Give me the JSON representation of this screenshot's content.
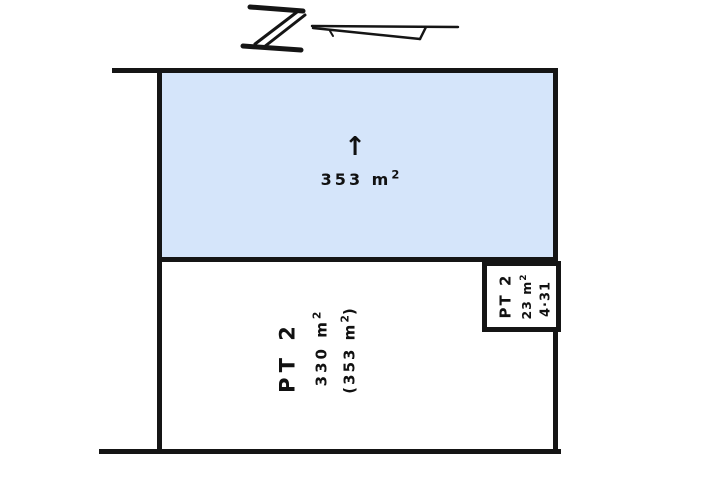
{
  "plan_type": "cadastral survey plan",
  "colors": {
    "line": "#151515",
    "lot_fill": "#d5e5fa",
    "background": "#ffffff"
  },
  "north": {
    "icon": "north-direction-arrow"
  },
  "lot_blue": {
    "direction_arrow": "↑",
    "area_value": "353 m",
    "area_sup": "2"
  },
  "lot_main": {
    "name": "PT 2",
    "area_value": "330 m",
    "area_sup": "2",
    "total_open": "(353 m",
    "total_sup": "2",
    "total_close": ")"
  },
  "lot_small": {
    "name": "PT 2",
    "area_value": "23 m",
    "area_sup": "2",
    "boundary_dim": "4·31"
  }
}
